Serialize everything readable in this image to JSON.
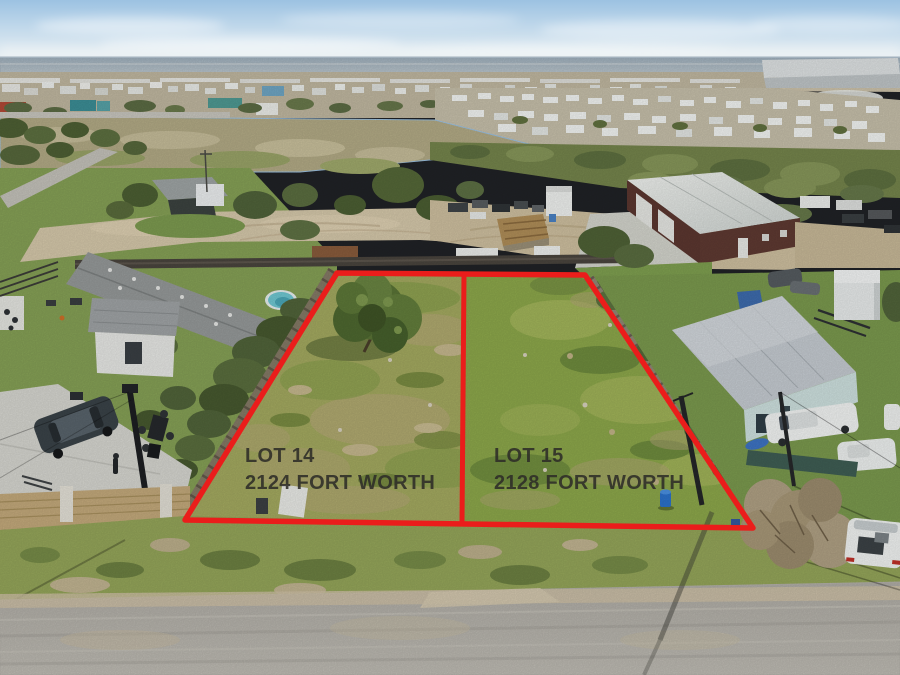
{
  "photo": {
    "kind": "aerial-drone-real-estate-photo",
    "overlay": {
      "line_color": "#ea1d1b",
      "label_color": "#2e2d28",
      "lots": [
        {
          "lot_label": "LOT 14",
          "address_label": "2124 FORT WORTH"
        },
        {
          "lot_label": "LOT 15",
          "address_label": "2128 FORT WORTH"
        }
      ]
    },
    "palette": {
      "sky_top": "#9cc2e2",
      "water": "#a3b1bc",
      "lot14_grass": "#a4aa60",
      "lot15_grass": "#8da84b",
      "dirt_road": "#d6c9ab",
      "gravel_road": "#b5b2ab",
      "barn_wall": "#5c3730",
      "barn_roof": "#e9ece9",
      "concrete_driveway": "#d7d7d1",
      "wood_fence": "#857a66"
    }
  }
}
